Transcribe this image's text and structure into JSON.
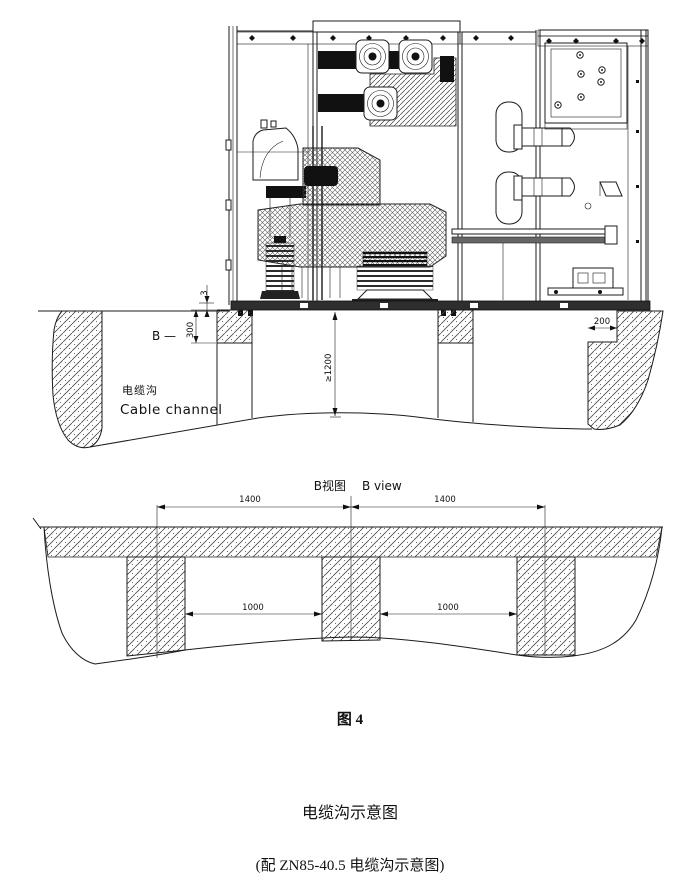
{
  "section_view": {
    "section_label": "B —",
    "channel_label_zh": "电缆沟",
    "channel_label_en": "Cable channel",
    "dim_gap": "3",
    "dim_foundation_height": "300",
    "dim_trench_depth": "≥1200",
    "dim_ledge_width": "200"
  },
  "b_view": {
    "title_zh": "B视图",
    "title_en": "B view",
    "dim_span_left": "1400",
    "dim_span_right": "1400",
    "dim_opening_left": "1000",
    "dim_opening_right": "1000"
  },
  "captions": {
    "figure_label": "图 4",
    "title": "电缆沟示意图",
    "subtitle": "(配 ZN85-40.5 电缆沟示意图)"
  }
}
